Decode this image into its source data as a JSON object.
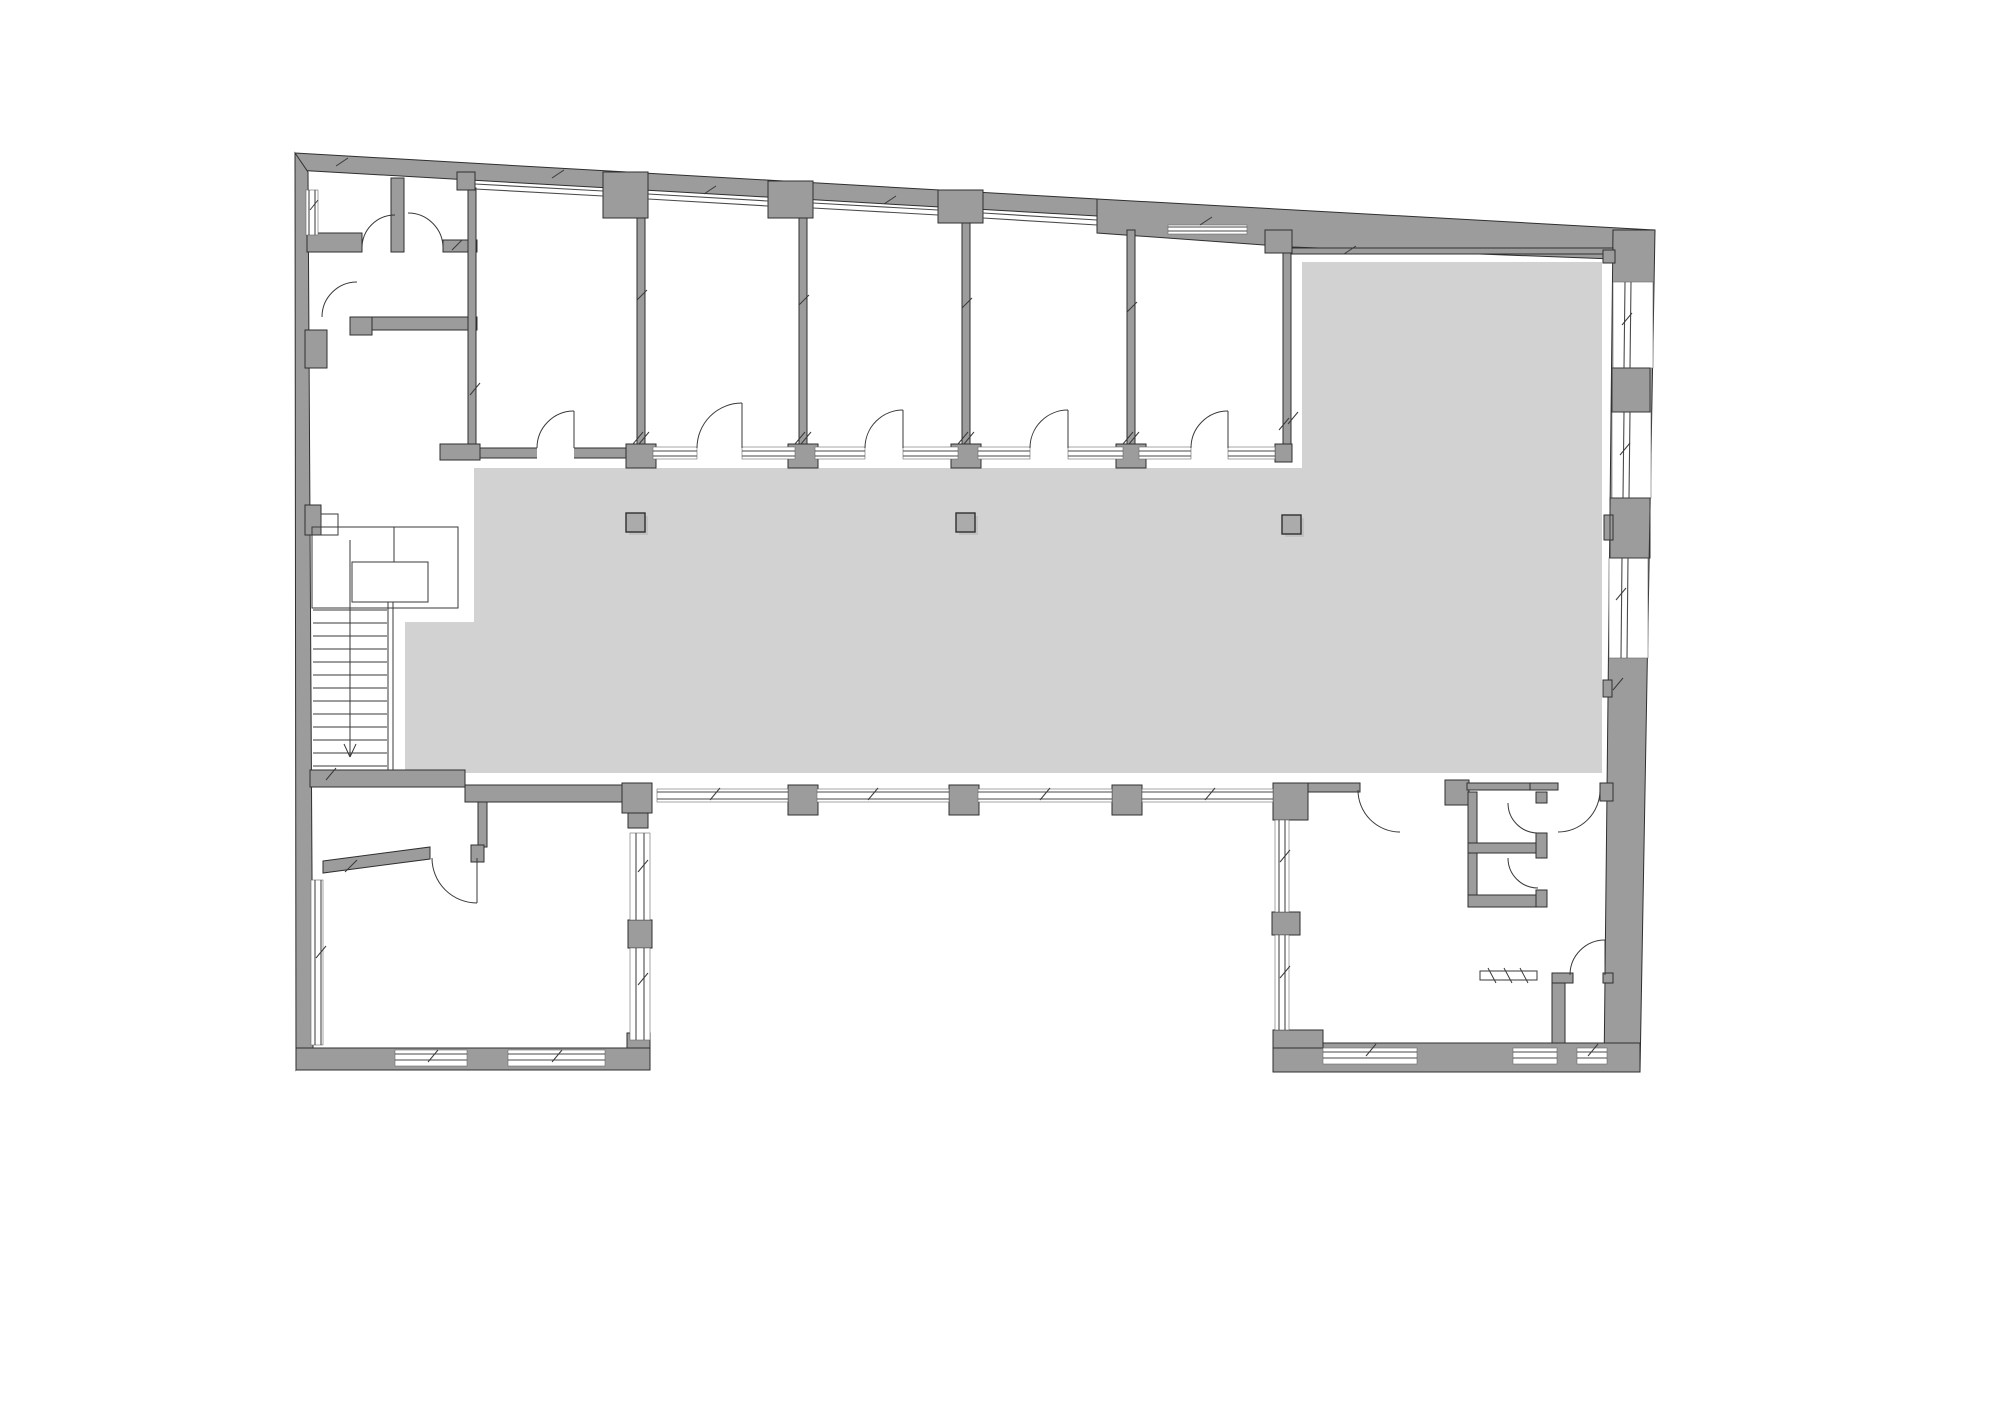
{
  "document": {
    "type": "architectural-floor-plan",
    "canvas": {
      "width": 2000,
      "height": 1414
    }
  },
  "colors": {
    "background": "#ffffff",
    "wall_fill": "#9c9c9c",
    "wall_stroke": "#2f2f2f",
    "floor_fill": "#d2d2d2",
    "glass_stroke": "#4a4a4a",
    "thin_stroke": "#3a3a3a",
    "column_fill": "#ababab",
    "column_shadow": "#c2c2c2"
  },
  "plan": {
    "floor_polygon": [
      [
        474,
        468
      ],
      [
        1302,
        468
      ],
      [
        1302,
        262
      ],
      [
        1602,
        262
      ],
      [
        1602,
        773
      ],
      [
        405,
        773
      ],
      [
        405,
        622
      ],
      [
        474,
        622
      ]
    ],
    "wall_polygons": [
      [
        [
          295,
          153
        ],
        [
          1097,
          199
        ],
        [
          1097,
          216
        ],
        [
          295,
          170
        ]
      ],
      [
        [
          1097,
          199
        ],
        [
          1655,
          230
        ],
        [
          1655,
          232
        ],
        [
          1613,
          259
        ],
        [
          1292,
          247
        ],
        [
          1097,
          233
        ]
      ],
      [
        [
          1613,
          230
        ],
        [
          1655,
          230
        ],
        [
          1648,
          282
        ],
        [
          1613,
          282
        ]
      ],
      [
        [
          295,
          153
        ],
        [
          308,
          172
        ],
        [
          313,
          1048
        ],
        [
          296,
          1070
        ]
      ],
      [
        [
          1655,
          230
        ],
        [
          1640,
          1072
        ],
        [
          1604,
          1072
        ],
        [
          1613,
          230
        ]
      ],
      [
        [
          323,
          861
        ],
        [
          430,
          847
        ],
        [
          430,
          859
        ],
        [
          323,
          873
        ]
      ]
    ],
    "wall_rects": [
      [
        440,
        448,
        852,
        10
      ],
      [
        465,
        785,
        158,
        17
      ],
      [
        478,
        802,
        9,
        45
      ],
      [
        471,
        845,
        13,
        17
      ],
      [
        310,
        770,
        155,
        17
      ],
      [
        296,
        1048,
        354,
        22
      ],
      [
        1273,
        1043,
        367,
        29
      ],
      [
        637,
        218,
        8,
        230
      ],
      [
        799,
        218,
        8,
        230
      ],
      [
        962,
        223,
        8,
        225
      ],
      [
        1127,
        230,
        8,
        218
      ],
      [
        1283,
        253,
        8,
        207
      ],
      [
        1292,
        248,
        321,
        6
      ],
      [
        1603,
        250,
        12,
        13
      ],
      [
        307,
        233,
        55,
        19
      ],
      [
        391,
        178,
        13,
        74
      ],
      [
        443,
        240,
        34,
        12
      ],
      [
        372,
        317,
        105,
        13
      ],
      [
        350,
        317,
        22,
        18
      ],
      [
        468,
        188,
        8,
        260
      ],
      [
        305,
        330,
        22,
        38
      ],
      [
        457,
        172,
        18,
        18
      ],
      [
        603,
        172,
        45,
        46
      ],
      [
        768,
        181,
        45,
        37
      ],
      [
        938,
        190,
        45,
        33
      ],
      [
        1265,
        230,
        27,
        23
      ],
      [
        626,
        444,
        30,
        24
      ],
      [
        788,
        444,
        30,
        24
      ],
      [
        951,
        444,
        30,
        24
      ],
      [
        1116,
        444,
        30,
        24
      ],
      [
        440,
        444,
        40,
        16
      ],
      [
        1275,
        444,
        17,
        18
      ],
      [
        622,
        783,
        30,
        30
      ],
      [
        628,
        813,
        20,
        15
      ],
      [
        788,
        785,
        30,
        30
      ],
      [
        949,
        785,
        30,
        30
      ],
      [
        1112,
        785,
        30,
        30
      ],
      [
        628,
        920,
        24,
        28
      ],
      [
        627,
        1033,
        23,
        15
      ],
      [
        305,
        505,
        16,
        30
      ],
      [
        1604,
        515,
        9,
        25
      ],
      [
        1603,
        680,
        9,
        17
      ],
      [
        1273,
        783,
        35,
        37
      ],
      [
        1272,
        912,
        28,
        23
      ],
      [
        1273,
        1030,
        50,
        18
      ],
      [
        1308,
        783,
        52,
        9
      ],
      [
        1445,
        780,
        24,
        25
      ],
      [
        1467,
        783,
        63,
        7
      ],
      [
        1530,
        783,
        28,
        7
      ],
      [
        1600,
        783,
        13,
        18
      ],
      [
        1468,
        792,
        9,
        115
      ],
      [
        1468,
        843,
        79,
        10
      ],
      [
        1468,
        895,
        79,
        12
      ],
      [
        1536,
        792,
        11,
        11
      ],
      [
        1536,
        833,
        11,
        25
      ],
      [
        1536,
        890,
        11,
        17
      ],
      [
        1552,
        973,
        13,
        70
      ],
      [
        1552,
        973,
        21,
        10
      ],
      [
        1603,
        973,
        10,
        10
      ]
    ],
    "door_openings": [
      [
        537,
        446,
        37,
        13
      ],
      [
        697,
        446,
        45,
        13
      ],
      [
        865,
        446,
        38,
        13
      ],
      [
        1030,
        446,
        38,
        13
      ],
      [
        1191,
        446,
        37,
        13
      ]
    ],
    "window_bg_rects": [
      [
        653,
        447,
        44,
        12
      ],
      [
        742,
        447,
        53,
        12
      ],
      [
        815,
        447,
        50,
        12
      ],
      [
        903,
        447,
        55,
        12
      ],
      [
        978,
        447,
        52,
        12
      ],
      [
        1068,
        447,
        55,
        12
      ],
      [
        1139,
        447,
        52,
        12
      ],
      [
        1228,
        447,
        47,
        12
      ],
      [
        657,
        789,
        131,
        13
      ],
      [
        817,
        789,
        132,
        13
      ],
      [
        978,
        789,
        134,
        13
      ],
      [
        1142,
        789,
        131,
        13
      ],
      [
        1613,
        282,
        40,
        86
      ],
      [
        1612,
        412,
        39,
        86
      ],
      [
        1609,
        558,
        39,
        100
      ],
      [
        1168,
        225,
        79,
        9
      ],
      [
        395,
        1050,
        72,
        16
      ],
      [
        508,
        1050,
        97,
        16
      ],
      [
        1323,
        1048,
        94,
        16
      ],
      [
        1513,
        1048,
        44,
        16
      ],
      [
        1577,
        1048,
        30,
        16
      ],
      [
        311,
        880,
        12,
        165
      ],
      [
        306,
        190,
        12,
        45
      ],
      [
        630,
        833,
        20,
        87
      ],
      [
        630,
        948,
        20,
        92
      ],
      [
        1275,
        820,
        14,
        92
      ],
      [
        1275,
        935,
        14,
        95
      ]
    ],
    "glass_lines": [
      [
        475,
        184,
        603,
        191
      ],
      [
        475,
        189,
        603,
        196
      ],
      [
        648,
        194,
        768,
        201
      ],
      [
        648,
        199,
        768,
        206
      ],
      [
        813,
        203,
        938,
        210
      ],
      [
        813,
        208,
        938,
        215
      ],
      [
        983,
        213,
        1097,
        220
      ],
      [
        983,
        218,
        1097,
        225
      ],
      [
        653,
        451,
        697,
        451
      ],
      [
        653,
        456,
        697,
        456
      ],
      [
        742,
        451,
        795,
        451
      ],
      [
        742,
        456,
        795,
        456
      ],
      [
        815,
        451,
        865,
        451
      ],
      [
        815,
        456,
        865,
        456
      ],
      [
        903,
        451,
        958,
        451
      ],
      [
        903,
        456,
        958,
        456
      ],
      [
        978,
        451,
        1030,
        451
      ],
      [
        978,
        456,
        1030,
        456
      ],
      [
        1068,
        451,
        1123,
        451
      ],
      [
        1068,
        456,
        1123,
        456
      ],
      [
        1139,
        451,
        1191,
        451
      ],
      [
        1139,
        456,
        1191,
        456
      ],
      [
        1228,
        451,
        1275,
        451
      ],
      [
        1228,
        456,
        1275,
        456
      ],
      [
        657,
        792,
        788,
        792
      ],
      [
        657,
        799,
        788,
        799
      ],
      [
        817,
        792,
        949,
        792
      ],
      [
        817,
        799,
        949,
        799
      ],
      [
        978,
        792,
        1112,
        792
      ],
      [
        978,
        799,
        1112,
        799
      ],
      [
        1142,
        792,
        1273,
        792
      ],
      [
        1142,
        799,
        1273,
        799
      ],
      [
        1625,
        282,
        1624,
        368
      ],
      [
        1631,
        282,
        1630,
        368
      ],
      [
        1624,
        412,
        1623,
        498
      ],
      [
        1630,
        412,
        1629,
        498
      ],
      [
        1622,
        558,
        1621,
        658
      ],
      [
        1628,
        558,
        1627,
        658
      ],
      [
        1168,
        227,
        1247,
        227
      ],
      [
        1168,
        231,
        1247,
        231
      ],
      [
        395,
        1054,
        467,
        1054
      ],
      [
        395,
        1060,
        467,
        1060
      ],
      [
        508,
        1054,
        605,
        1054
      ],
      [
        508,
        1060,
        605,
        1060
      ],
      [
        1323,
        1052,
        1417,
        1052
      ],
      [
        1323,
        1058,
        1417,
        1058
      ],
      [
        1513,
        1052,
        1557,
        1052
      ],
      [
        1513,
        1058,
        1557,
        1058
      ],
      [
        1577,
        1052,
        1607,
        1052
      ],
      [
        1577,
        1058,
        1607,
        1058
      ],
      [
        315,
        880,
        315,
        1045
      ],
      [
        321,
        880,
        321,
        1045
      ],
      [
        309,
        190,
        309,
        235
      ],
      [
        315,
        190,
        315,
        235
      ],
      [
        636,
        833,
        636,
        920
      ],
      [
        644,
        833,
        644,
        920
      ],
      [
        636,
        948,
        636,
        1040
      ],
      [
        644,
        948,
        644,
        1040
      ],
      [
        1279,
        820,
        1279,
        912
      ],
      [
        1285,
        820,
        1285,
        912
      ],
      [
        1279,
        935,
        1279,
        1030
      ],
      [
        1285,
        935,
        1285,
        1030
      ]
    ],
    "stroke_rects": [
      [
        312,
        527,
        146,
        81
      ],
      [
        352,
        562,
        76,
        40
      ],
      [
        321,
        514,
        17,
        21
      ],
      [
        1480,
        971,
        57,
        9
      ],
      [
        1612,
        368,
        38,
        44
      ],
      [
        1610,
        498,
        40,
        60
      ]
    ],
    "thin_lines": [
      [
        313,
        610,
        387,
        610
      ],
      [
        313,
        623,
        387,
        623
      ],
      [
        313,
        636,
        387,
        636
      ],
      [
        313,
        649,
        387,
        649
      ],
      [
        313,
        662,
        387,
        662
      ],
      [
        313,
        675,
        387,
        675
      ],
      [
        313,
        688,
        387,
        688
      ],
      [
        313,
        701,
        387,
        701
      ],
      [
        313,
        714,
        387,
        714
      ],
      [
        313,
        727,
        387,
        727
      ],
      [
        313,
        740,
        387,
        740
      ],
      [
        313,
        753,
        387,
        753
      ],
      [
        313,
        766,
        387,
        766
      ],
      [
        388,
        602,
        388,
        770
      ],
      [
        393,
        602,
        393,
        770
      ],
      [
        350,
        540,
        350,
        756
      ],
      [
        344,
        744,
        350,
        757
      ],
      [
        356,
        744,
        350,
        757
      ],
      [
        394,
        527,
        394,
        562
      ],
      [
        574,
        411,
        574,
        448
      ],
      [
        742,
        403,
        742,
        448
      ],
      [
        903,
        410,
        903,
        448
      ],
      [
        1068,
        410,
        1068,
        448
      ],
      [
        1228,
        411,
        1228,
        448
      ],
      [
        477,
        858,
        477,
        903
      ],
      [
        1605,
        940,
        1605,
        975
      ],
      [
        1488,
        968,
        1496,
        983
      ],
      [
        1504,
        968,
        1512,
        983
      ],
      [
        1520,
        968,
        1528,
        983
      ]
    ],
    "door_arcs": [
      [
        537,
        448,
        37,
        574,
        411,
        1
      ],
      [
        697,
        448,
        45,
        742,
        403,
        1
      ],
      [
        865,
        448,
        38,
        903,
        410,
        1
      ],
      [
        1030,
        448,
        38,
        1068,
        410,
        1
      ],
      [
        1191,
        448,
        37,
        1228,
        411,
        1
      ],
      [
        362,
        248,
        33,
        395,
        215,
        1
      ],
      [
        408,
        213,
        35,
        443,
        248,
        1
      ],
      [
        322,
        317,
        35,
        357,
        282,
        1
      ],
      [
        432,
        858,
        45,
        477,
        903,
        0
      ],
      [
        1358,
        790,
        42,
        1400,
        832,
        0
      ],
      [
        1600,
        790,
        42,
        1558,
        832,
        1
      ],
      [
        1508,
        803,
        30,
        1538,
        833,
        0
      ],
      [
        1508,
        858,
        30,
        1538,
        888,
        0
      ],
      [
        1605,
        940,
        35,
        1570,
        975,
        0
      ]
    ],
    "floor_columns": [
      [
        626,
        513,
        19,
        19
      ],
      [
        956,
        513,
        19,
        19
      ],
      [
        1282,
        515,
        19,
        19
      ]
    ],
    "tick_marks": [
      [
        336,
        166,
        348,
        158
      ],
      [
        552,
        178,
        564,
        170
      ],
      [
        704,
        194,
        716,
        186
      ],
      [
        884,
        204,
        896,
        196
      ],
      [
        1200,
        225,
        1212,
        217
      ],
      [
        1344,
        254,
        1356,
        246
      ],
      [
        633,
        444,
        643,
        432
      ],
      [
        639,
        444,
        649,
        432
      ],
      [
        795,
        444,
        805,
        432
      ],
      [
        801,
        444,
        811,
        432
      ],
      [
        958,
        444,
        968,
        432
      ],
      [
        964,
        444,
        974,
        432
      ],
      [
        1123,
        444,
        1133,
        432
      ],
      [
        1129,
        444,
        1139,
        432
      ],
      [
        1279,
        430,
        1289,
        418
      ],
      [
        710,
        800,
        720,
        788
      ],
      [
        868,
        800,
        878,
        788
      ],
      [
        1040,
        800,
        1050,
        788
      ],
      [
        1205,
        800,
        1215,
        788
      ],
      [
        1622,
        325,
        1632,
        313
      ],
      [
        1620,
        455,
        1630,
        443
      ],
      [
        1616,
        600,
        1626,
        588
      ],
      [
        1613,
        690,
        1623,
        678
      ],
      [
        345,
        872,
        357,
        860
      ],
      [
        316,
        958,
        326,
        946
      ],
      [
        638,
        872,
        648,
        860
      ],
      [
        638,
        985,
        648,
        973
      ],
      [
        428,
        1062,
        438,
        1050
      ],
      [
        552,
        1062,
        562,
        1050
      ],
      [
        1280,
        862,
        1290,
        850
      ],
      [
        1280,
        978,
        1290,
        966
      ],
      [
        1366,
        1056,
        1376,
        1044
      ],
      [
        1588,
        1056,
        1598,
        1044
      ],
      [
        310,
        210,
        318,
        200
      ],
      [
        452,
        250,
        462,
        240
      ],
      [
        470,
        395,
        480,
        383
      ],
      [
        326,
        780,
        336,
        768
      ],
      [
        1288,
        424,
        1298,
        412
      ],
      [
        637,
        300,
        647,
        290
      ],
      [
        799,
        305,
        809,
        295
      ],
      [
        962,
        308,
        972,
        298
      ],
      [
        1127,
        312,
        1137,
        302
      ]
    ]
  }
}
